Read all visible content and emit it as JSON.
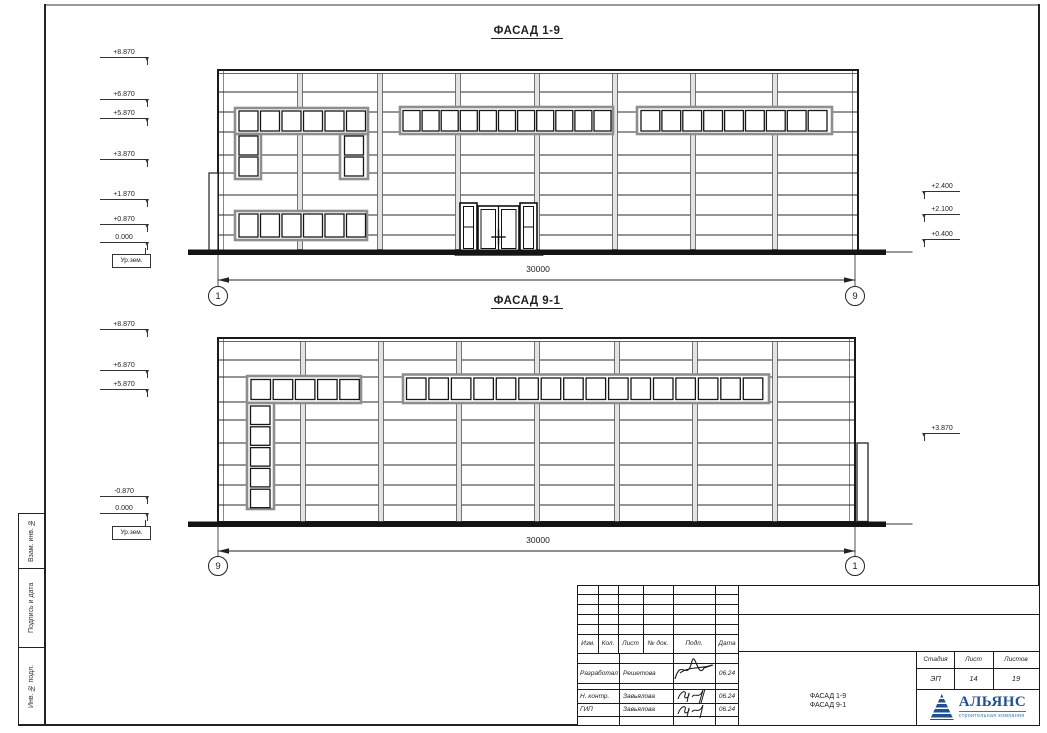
{
  "sheet": {
    "side_labels": [
      "Взам. инв. №",
      "Подпись и дата",
      "Инв. № подл."
    ]
  },
  "facade1": {
    "title": "ФАСАД 1-9",
    "dimension": "30000",
    "axis_left": "1",
    "axis_right": "9",
    "marks_left": [
      "+8.870",
      "+6.870",
      "+5.870",
      "+3.870",
      "+1.870",
      "+0.870",
      "0.000"
    ],
    "ground_label": "Ур.зем.",
    "marks_right": [
      "+2.400",
      "+2.100",
      "+0.400"
    ]
  },
  "facade2": {
    "title": "ФАСАД 9-1",
    "dimension": "30000",
    "axis_left": "9",
    "axis_right": "1",
    "marks_left": [
      "+8.870",
      "+6.870",
      "+5.870",
      "-0.870",
      "0.000"
    ],
    "ground_label": "Ур.зем.",
    "marks_right": [
      "+3.870"
    ]
  },
  "titleblock": {
    "cols": [
      "Изм.",
      "Кол.",
      "Лист",
      "№ док.",
      "Подп.",
      "Дата"
    ],
    "rows": [
      {
        "role": "Разработал",
        "name": "Решетова",
        "date": "06.24"
      },
      {
        "role": "Н. контр.",
        "name": "Завьялова",
        "date": "06.24"
      },
      {
        "role": "ГИП",
        "name": "Завьялова",
        "date": "06.24"
      }
    ],
    "stage_label": "Стадия",
    "sheet_label": "Лист",
    "sheets_label": "Листов",
    "stage": "ЭП",
    "sheet_no": "14",
    "sheets_total": "19",
    "doc_title_line1": "ФАСАД 1-9",
    "doc_title_line2": "ФАСАД 9-1",
    "company": "АЛЬЯНС",
    "company_sub": "строительная компания"
  },
  "colors": {
    "logo_blue": "#1c4f9c",
    "logo_accent": "#2e7cc0",
    "line_dark": "#1a1a1a",
    "joint_gray": "#e3e3e3"
  }
}
